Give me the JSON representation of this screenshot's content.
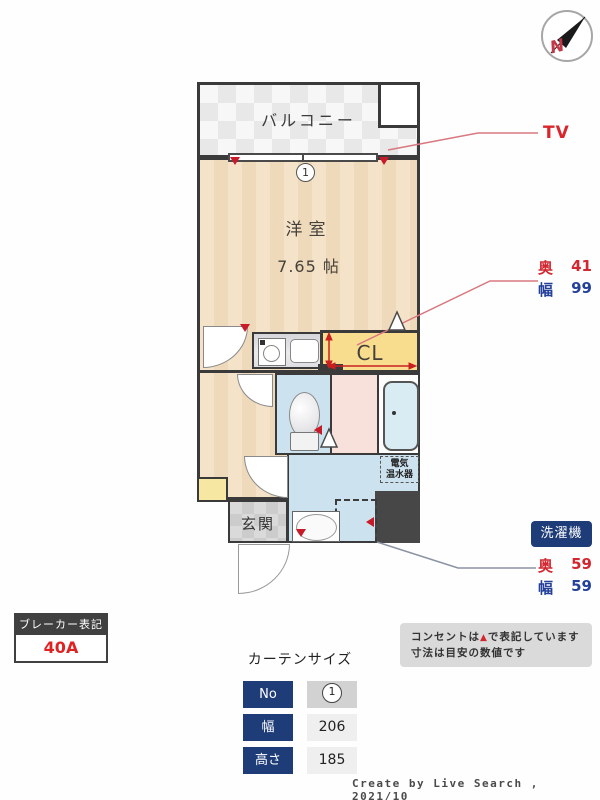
{
  "compass": {
    "label": "N"
  },
  "plan": {
    "balcony_label": "バルコニー",
    "window_number": "1",
    "room_name": "洋室",
    "room_size": "7.65 帖",
    "closet_label": "CL",
    "entrance_label": "玄関",
    "water_heater_line1": "電気",
    "water_heater_line2": "温水器"
  },
  "annotations": {
    "tv_label": "TV",
    "closet_depth_label": "奥",
    "closet_depth_value": "41",
    "closet_width_label": "幅",
    "closet_width_value": "99",
    "washer_badge": "洗濯機",
    "washer_depth_label": "奥",
    "washer_depth_value": "59",
    "washer_width_label": "幅",
    "washer_width_value": "59"
  },
  "breaker": {
    "title": "ブレーカー表記",
    "value": "40A"
  },
  "curtain_table": {
    "title": "カーテンサイズ",
    "rows": [
      {
        "label": "No",
        "value": "1"
      },
      {
        "label": "幅",
        "value": "206"
      },
      {
        "label": "高さ",
        "value": "185"
      }
    ]
  },
  "notes": {
    "line1_pre": "コンセントは",
    "line1_marker": "▲",
    "line1_post": "で表記しています",
    "line2": "寸法は目安の数値です"
  },
  "credit": "Create by Live Search , 2021/10",
  "colors": {
    "accent_red": "#d22730",
    "accent_blue": "#24409a",
    "badge_blue": "#1e3c78",
    "wall": "#3a3a3a",
    "floor_beige": "#f4e3c9",
    "floor_blue": "#cde2ef",
    "floor_pink": "#f8e1db",
    "closet_yellow": "#f9dd8e"
  }
}
